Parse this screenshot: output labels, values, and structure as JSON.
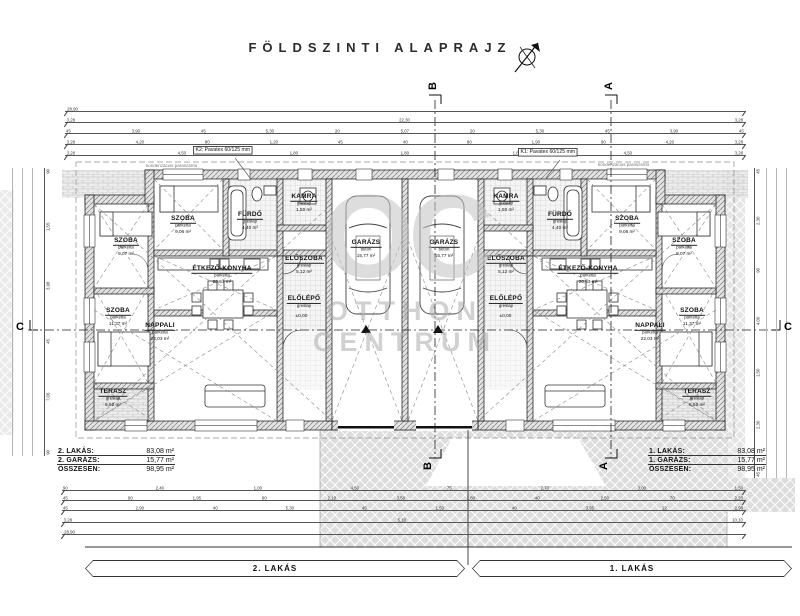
{
  "title": "FÖLDSZINTI ALAPRAJZ",
  "watermark": {
    "logo": "OC",
    "line1": "OTTHON",
    "line2": "CENTRUM"
  },
  "bars": {
    "left": "2. LAKÁS",
    "right": "1. LAKÁS"
  },
  "tables": {
    "left": {
      "rows": [
        {
          "label": "2. LAKÁS:",
          "value": "83,08 m²"
        },
        {
          "label": "2. GARÁZS:",
          "value": "15,77 m²"
        },
        {
          "label": "ÖSSZESEN:",
          "value": "98,95 m²"
        }
      ]
    },
    "right": {
      "rows": [
        {
          "label": "1. LAKÁS:",
          "value": "83,08 m²"
        },
        {
          "label": "1. GARÁZS:",
          "value": "15,77 m²"
        },
        {
          "label": "ÖSSZESEN:",
          "value": "98,95 m²"
        }
      ]
    }
  },
  "sections": {
    "a": "A",
    "b": "B",
    "c": "C"
  },
  "callouts": {
    "left_box": "K2: Pavatex 60/125 mm",
    "left_note": "kondenzációs páraszárító",
    "right_box": "K1: Pavatex 60/125 mm",
    "right_note": "kondenzációs páraszárító"
  },
  "elevations": {
    "zero": "±0,00"
  },
  "rooms": [
    {
      "name": "SZOBA",
      "finish": "parketta",
      "area": "9,06 m²",
      "x": 183,
      "y": 226
    },
    {
      "name": "FÜRDŐ",
      "finish": "greslap",
      "area": "4,40 m²",
      "x": 250,
      "y": 222
    },
    {
      "name": "KAMRA",
      "finish": "greslap",
      "area": "1,50 m²",
      "x": 304,
      "y": 204
    },
    {
      "name": "SZOBA",
      "finish": "parketta",
      "area": "9,07 m²",
      "x": 126,
      "y": 248
    },
    {
      "name": "SZOBA",
      "finish": "parketta",
      "area": "11,37 m²",
      "x": 118,
      "y": 318
    },
    {
      "name": "ÉTKEZŐ-KONYHA",
      "finish": "parketta",
      "area": "20,53 m²",
      "x": 222,
      "y": 276
    },
    {
      "name": "ELŐSZOBA",
      "finish": "greslap",
      "area": "5,12 m²",
      "x": 304,
      "y": 266
    },
    {
      "name": "ELŐLÉPŐ",
      "finish": "greslap",
      "area": "",
      "x": 304,
      "y": 303
    },
    {
      "name": "NAPPALI",
      "finish": "parketta",
      "area": "22,03 m²",
      "x": 160,
      "y": 333
    },
    {
      "name": "TERASZ",
      "finish": "greslap",
      "area": "8,52 m²",
      "x": 113,
      "y": 399
    },
    {
      "name": "GARÁZS",
      "finish": "beton",
      "area": "15,77 m²",
      "x": 366,
      "y": 250
    },
    {
      "name": "GARÁZS",
      "finish": "beton",
      "area": "15,77 m²",
      "x": 444,
      "y": 250
    },
    {
      "name": "SZOBA",
      "finish": "parketta",
      "area": "9,06 m²",
      "x": 627,
      "y": 226
    },
    {
      "name": "FÜRDŐ",
      "finish": "greslap",
      "area": "4,40 m²",
      "x": 560,
      "y": 222
    },
    {
      "name": "KAMRA",
      "finish": "greslap",
      "area": "1,50 m²",
      "x": 506,
      "y": 204
    },
    {
      "name": "SZOBA",
      "finish": "parketta",
      "area": "9,07 m²",
      "x": 684,
      "y": 248
    },
    {
      "name": "SZOBA",
      "finish": "parketta",
      "area": "11,37 m²",
      "x": 692,
      "y": 318
    },
    {
      "name": "ÉTKEZŐ-KONYHA",
      "finish": "parketta",
      "area": "20,53 m²",
      "x": 588,
      "y": 276
    },
    {
      "name": "ELŐSZOBA",
      "finish": "greslap",
      "area": "5,12 m²",
      "x": 506,
      "y": 266
    },
    {
      "name": "ELŐLÉPŐ",
      "finish": "greslap",
      "area": "",
      "x": 506,
      "y": 303
    },
    {
      "name": "NAPPALI",
      "finish": "parketta",
      "area": "22,03 m²",
      "x": 650,
      "y": 333
    },
    {
      "name": "TERASZ",
      "finish": "greslap",
      "area": "8,52 m²",
      "x": 697,
      "y": 399
    }
  ],
  "dims": {
    "top": [
      [
        "28,90"
      ],
      [
        "3,28",
        "22,30",
        "3,28"
      ],
      [
        "45",
        "3,90",
        "45",
        "5,30",
        "20",
        "5,07",
        "20",
        "5,30",
        "45",
        "3,90",
        "45"
      ],
      [
        "3,28",
        "4,20",
        "80",
        "1,20",
        "45",
        "40",
        "80",
        "1,90",
        "90",
        "4,20",
        "3,28"
      ],
      [
        "3,28",
        "4,50",
        "1,80",
        "1,80",
        "1,80",
        "4,50",
        "3,28"
      ]
    ],
    "bottom": [
      [
        "90",
        "2,40",
        "1,00",
        "4,50",
        "75",
        "2,70",
        "3,00",
        "1,50"
      ],
      [
        "45",
        "90",
        "1,95",
        "90",
        "2,10",
        "3,50",
        "1,80",
        "40",
        "2,50",
        "70",
        "2,20"
      ],
      [
        "45",
        "2,90",
        "40",
        "5,30",
        "45",
        "1,50",
        "40",
        "3,95",
        "12",
        "2,98"
      ],
      [
        "3,28",
        "5,10",
        "10,10"
      ],
      [
        "28,90"
      ]
    ],
    "left": [
      "90",
      "1,55",
      "3,98",
      "45",
      "7,06",
      "90"
    ],
    "right": [
      "45",
      "2,30",
      "90",
      "4,00",
      "1,50",
      "2,30",
      "45"
    ]
  }
}
